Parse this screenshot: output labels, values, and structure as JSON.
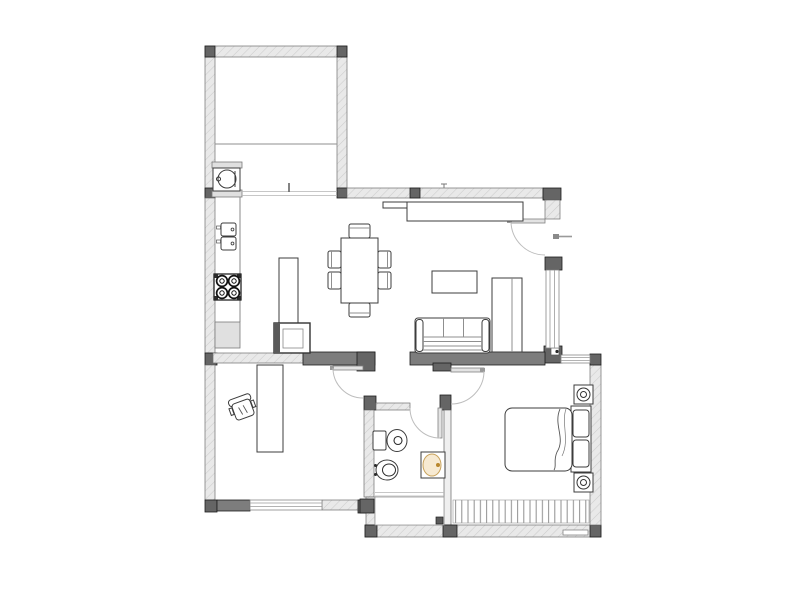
{
  "canvas": {
    "width": 800,
    "height": 600,
    "background": "#ffffff"
  },
  "palette": {
    "wall_light": "#e9e9e9",
    "wall_hatch": "#cccccc",
    "wall_dark": "#7d7d7d",
    "wall_block": "#656565",
    "furniture_line": "#3c3c3c",
    "door_arc": "#bdbdbd",
    "window_glass": "#9a9a9a",
    "basin_fill": "#f7ead2",
    "basin_rim": "#c9a35c",
    "basin_faucet_dot": "#b9872e"
  },
  "inventory": {
    "rooms": [
      "utility-room",
      "kitchen-living-dining",
      "office",
      "bathroom",
      "bedroom",
      "hall"
    ],
    "doors": 4,
    "windows": 3,
    "stove_burners": 4,
    "dining_chairs": 6,
    "sofa_seats": 3,
    "nightstands": 2,
    "bathroom_fixtures": [
      "toilet",
      "bidet",
      "washbasin",
      "bathtub"
    ]
  }
}
